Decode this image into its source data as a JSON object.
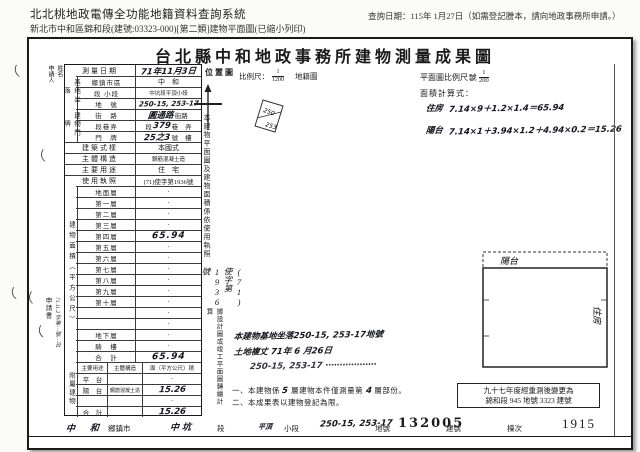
{
  "header": {
    "system_title": "北北桃地政電傳全功能地籍資料查詢系統",
    "query_date": "查詢日期：115年 1月27日（如需登記謄本，請向地政事務所申請。）",
    "doc_line": "新北市中和區錦和段(建號:03323-000)[第二類]建物平面圖(已縮小列印)"
  },
  "form": {
    "title": "台北縣中和地政事務所建物測量成果圖",
    "applicant": {
      "line1": "申請人",
      "line2": "姓名"
    },
    "file_stamp": {
      "label": "申請書",
      "hw": "71.11.2 字第⋯號⋯日"
    },
    "survey_date": {
      "label": "測量日期",
      "value": "71年11月3日"
    },
    "groups": {
      "site": "基地坐落",
      "address": "建物門牌",
      "area": "建物面積（平方公尺）",
      "annex": "附屬建物"
    },
    "site": {
      "district_label": "鄉鎮市區",
      "district": "中　和",
      "section_label": "段 小段",
      "section": "中坑段平頂小段",
      "lot_label": "地　號",
      "lot": "250-15, 253-17"
    },
    "address": {
      "street_label": "街　路",
      "street": "圓通路",
      "street_suffix": "街路",
      "lane_label": "段巷弄",
      "lane_prefix": "段",
      "lane": "379",
      "lane_mid": "巷",
      "lane_suffix": "弄",
      "no_label": "門　牌",
      "no": "25之3",
      "no_mid": "號",
      "no_suffix": "樓"
    },
    "style_label": "建築式樣",
    "style": "本國式",
    "structure_label": "主體構造",
    "structure": "鋼筋混凝土造",
    "usage_label": "主要用途",
    "usage": "住　宅",
    "license_label": "使用執照",
    "license": "(71)使字第1936號",
    "floors": [
      {
        "label": "地面層",
        "value": "·"
      },
      {
        "label": "第一層",
        "value": "·"
      },
      {
        "label": "第二層",
        "value": "·"
      },
      {
        "label": "第三層",
        "value": "·"
      },
      {
        "label": "第四層",
        "value": "65.94"
      },
      {
        "label": "第五層",
        "value": "·"
      },
      {
        "label": "第六層",
        "value": "·"
      },
      {
        "label": "第七層",
        "value": "·"
      },
      {
        "label": "第八層",
        "value": "·"
      },
      {
        "label": "第九層",
        "value": "·"
      },
      {
        "label": "第十層",
        "value": "·"
      },
      {
        "label": "",
        "value": "·"
      },
      {
        "label": "",
        "value": "·"
      },
      {
        "label": "地下層",
        "value": "·"
      },
      {
        "label": "騎　樓",
        "value": "·"
      },
      {
        "label": "合　計",
        "value": "65.94"
      }
    ],
    "annex": {
      "headers": [
        "主要用途",
        "主體構造",
        "面（平方公尺）積"
      ],
      "rows": [
        {
          "use": "平　台",
          "structure": "",
          "area": "·"
        },
        {
          "use": "陽　台",
          "structure": "鋼筋混凝土造",
          "area": "15.26"
        },
        {
          "use": "",
          "structure": "",
          "area": "·"
        },
        {
          "use": "合　計",
          "structure": "",
          "area": "15.26"
        }
      ]
    }
  },
  "map": {
    "label": "位置圖",
    "scale_label": "比例尺：",
    "scale_num": "1",
    "scale_den": "1200",
    "ref_label": "地籍圖",
    "sheet_label": "號",
    "sketch_labels": [
      "250",
      "253"
    ]
  },
  "plan": {
    "scale_label": "平面圖比例尺：",
    "scale_num": "1",
    "scale_den": "200",
    "calc_label": "面積計算式：",
    "calc1_name": "住房",
    "calc1": "7.14×9＋1.2×1.4＝65.94",
    "calc2_name": "陽台",
    "calc2": "7.14×1＋3.94×1.2＋4.94×0.2＝15.26",
    "balcony_label": "陽台",
    "room_label": "住房"
  },
  "notes": {
    "strip1": "本建物平面圖及建物面積係依使用執照",
    "strip1b": "(71)使字第1936號",
    "strip2": "據設計圖或竣工平面圖轉繪計算",
    "hw1": "本建物基地坐落250-15, 253-17地號",
    "hw2": "土地複丈 71年 6 月26日",
    "hw3": "250-15, 253-17 ⋯⋯⋯⋯⋯⋯",
    "n1_pre": "一、本建物係",
    "n1_hw1": "5",
    "n1_mid": "層建物本件僅測量第",
    "n1_hw2": "4",
    "n1_suf": "層部份。",
    "n2": "二、本成果表以建物登記為限。"
  },
  "remark_box": {
    "line1": "九十七年度經重測後變更為",
    "line2": "錦和段 945 地號 3323 建號"
  },
  "footer": {
    "v1": "中　和",
    "l1": "鄉鎮市",
    "v2": "中坑",
    "l2": "段",
    "v3": "平頂",
    "l3": "小段",
    "v4": "250-15, 253-17",
    "l4": "地號",
    "v5": "132005",
    "l5": "建號",
    "dong_label": "棟次",
    "page_no": "1915"
  },
  "artifact_glyph": "（"
}
